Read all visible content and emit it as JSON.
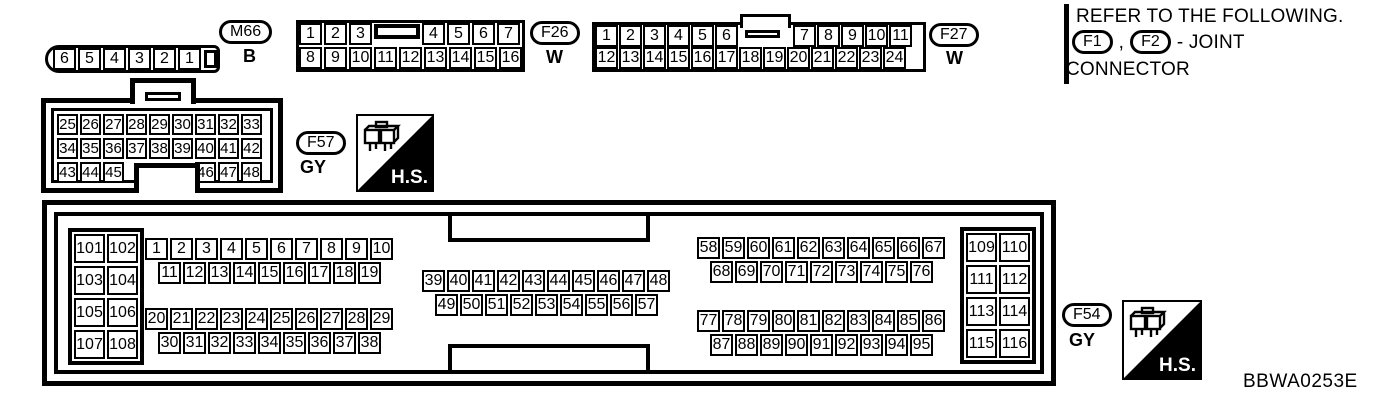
{
  "colors": {
    "ink": "#000000",
    "background": "#ffffff"
  },
  "figure_code": "BBWA0253E",
  "hs_badge": "H.S.",
  "note": {
    "line1": "REFER TO THE FOLLOWING.",
    "joint1": "F1",
    "separator": ",",
    "joint2": "F2",
    "suffix": "- JOINT",
    "line2": "CONNECTOR"
  },
  "connectors": {
    "m66": {
      "id": "M66",
      "color_code": "B",
      "pins": [
        "6",
        "5",
        "4",
        "3",
        "2",
        "1"
      ]
    },
    "f26": {
      "id": "F26",
      "color_code": "W",
      "row1_left": [
        "1",
        "2",
        "3"
      ],
      "row1_right": [
        "4",
        "5",
        "6",
        "7"
      ],
      "row2": [
        "8",
        "9",
        "10",
        "11",
        "12",
        "13",
        "14",
        "15",
        "16"
      ]
    },
    "f27": {
      "id": "F27",
      "color_code": "W",
      "row1_left": [
        "1",
        "2",
        "3",
        "4",
        "5",
        "6"
      ],
      "row1_right": [
        "7",
        "8",
        "9",
        "10",
        "11"
      ],
      "row2": [
        "12",
        "13",
        "14",
        "15",
        "16",
        "17",
        "18",
        "19",
        "20",
        "21",
        "22",
        "23",
        "24"
      ]
    },
    "f57": {
      "id": "F57",
      "color_code": "GY",
      "row1": [
        "25",
        "26",
        "27",
        "28",
        "29",
        "30",
        "31",
        "32",
        "33"
      ],
      "row2": [
        "34",
        "35",
        "36",
        "37",
        "38",
        "39",
        "40",
        "41",
        "42"
      ],
      "row3_left": [
        "43",
        "44",
        "45"
      ],
      "row3_right": [
        "46",
        "47",
        "48"
      ]
    },
    "f54": {
      "id": "F54",
      "color_code": "GY",
      "left_grid": [
        "101",
        "102",
        "103",
        "104",
        "105",
        "106",
        "107",
        "108"
      ],
      "right_grid": [
        "109",
        "110",
        "111",
        "112",
        "113",
        "114",
        "115",
        "116"
      ],
      "a1": [
        "1",
        "2",
        "3",
        "4",
        "5",
        "6",
        "7",
        "8",
        "9",
        "10"
      ],
      "a2": [
        "11",
        "12",
        "13",
        "14",
        "15",
        "16",
        "17",
        "18",
        "19"
      ],
      "b1": [
        "20",
        "21",
        "22",
        "23",
        "24",
        "25",
        "26",
        "27",
        "28",
        "29"
      ],
      "b2": [
        "30",
        "31",
        "32",
        "33",
        "34",
        "35",
        "36",
        "37",
        "38"
      ],
      "c1": [
        "39",
        "40",
        "41",
        "42",
        "43",
        "44",
        "45",
        "46",
        "47",
        "48"
      ],
      "c2": [
        "49",
        "50",
        "51",
        "52",
        "53",
        "54",
        "55",
        "56",
        "57"
      ],
      "d1": [
        "58",
        "59",
        "60",
        "61",
        "62",
        "63",
        "64",
        "65",
        "66",
        "67"
      ],
      "d2": [
        "68",
        "69",
        "70",
        "71",
        "72",
        "73",
        "74",
        "75",
        "76"
      ],
      "e1": [
        "77",
        "78",
        "79",
        "80",
        "81",
        "82",
        "83",
        "84",
        "85",
        "86"
      ],
      "e2": [
        "87",
        "88",
        "89",
        "90",
        "91",
        "92",
        "93",
        "94",
        "95"
      ]
    }
  }
}
